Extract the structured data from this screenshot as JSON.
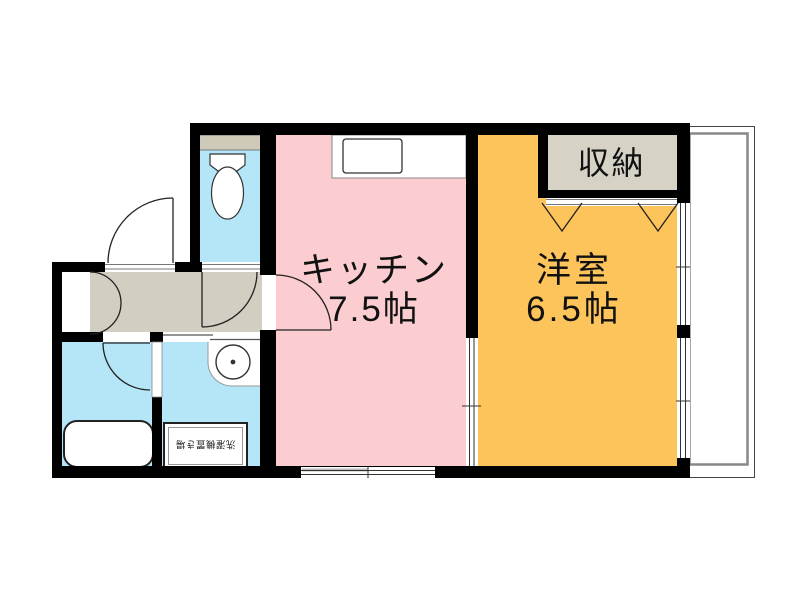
{
  "floorplan": {
    "rooms": {
      "kitchen": {
        "name": "キッチン",
        "size": "7.5帖"
      },
      "western_room": {
        "name": "洋室",
        "size": "6.5帖"
      },
      "closet": {
        "name": "収納"
      },
      "washer_pan": {
        "name": "洗濯機置き場"
      }
    },
    "colors": {
      "kitchen": "#fbcdd0",
      "western_room": "#fcc45a",
      "wet_area": "#b4e6f7",
      "hallway": "#d3cec2",
      "closet": "#d6d2c6",
      "toilet_shelf": "#cfc9ba",
      "wall": "#000000",
      "balcony_line": "#888888"
    }
  }
}
